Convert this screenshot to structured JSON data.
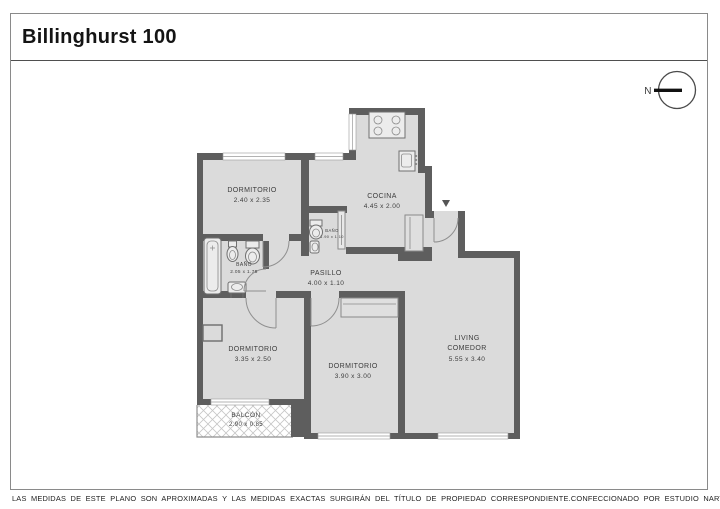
{
  "title": "Billinghurst 100",
  "compass": {
    "label": "N"
  },
  "rooms": {
    "dormitorio1": {
      "name": "DORMITORIO",
      "dims": "2.40 x 2.35"
    },
    "cocina": {
      "name": "COCINA",
      "dims": "4.45 x 2.00"
    },
    "bano1": {
      "name": "BAÑO",
      "dims": "2.05 x 1.75"
    },
    "bano2": {
      "name": "BAÑO",
      "dims": "1.90 x 1.10"
    },
    "pasillo": {
      "name": "PASILLO",
      "dims": "4.00 x 1.10"
    },
    "dormitorio2": {
      "name": "DORMITORIO",
      "dims": "3.35 x 2.50"
    },
    "dormitorio3": {
      "name": "DORMITORIO",
      "dims": "3.90 x 3.00"
    },
    "living": {
      "name": "LIVING",
      "name2": "COMEDOR",
      "dims": "5.55 x 3.40"
    },
    "balcon": {
      "name": "BALCÓN",
      "dims": "2.90 x 0.85"
    }
  },
  "footer": {
    "left": "LAS MEDIDAS DE ESTE PLANO SON APROXIMADAS Y LAS MEDIDAS EXACTAS SURGIRÁN DEL TÍTULO DE PROPIEDAD CORRESPONDIENTE.",
    "right": "CONFECCIONADO POR ESTUDIO NARTEX"
  },
  "colors": {
    "wall": "#5e5e5e",
    "floor": "#dbdbdb",
    "frame_border": "#8a8a8a",
    "text": "#3c3c3c"
  }
}
